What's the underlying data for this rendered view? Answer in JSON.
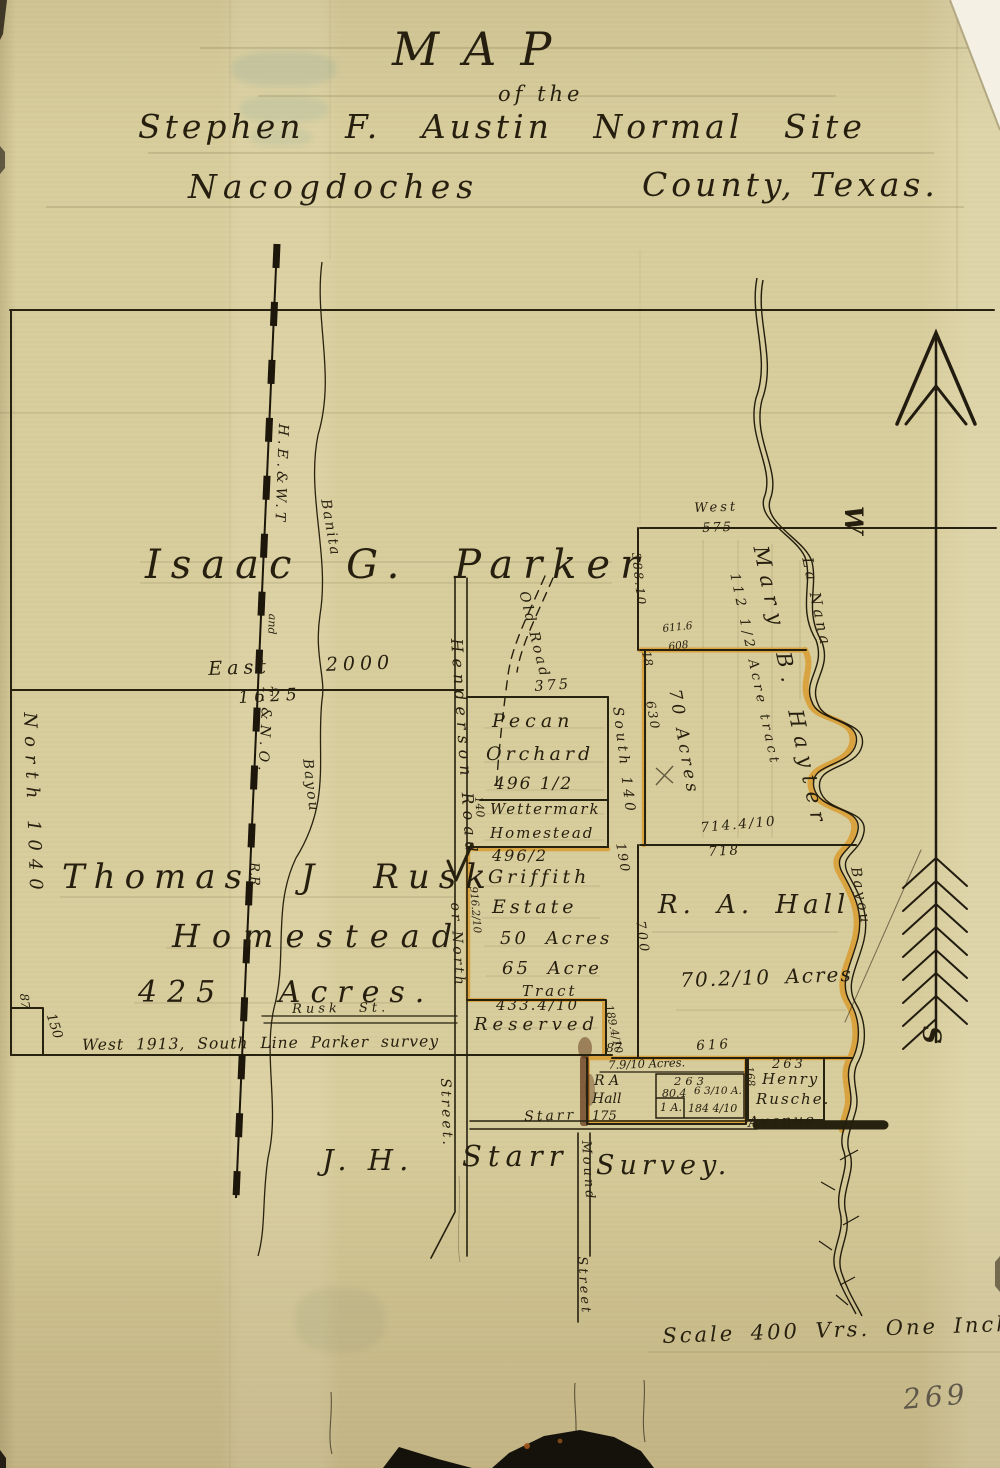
{
  "colors": {
    "paper": "#d8cd9c",
    "ink": "#261f0f",
    "highlight": "#d99b2c",
    "pencil": "#5e574a"
  },
  "title": {
    "map": "MAP",
    "of_the": "of the",
    "line3": "Stephen F. Austin Normal Site",
    "line4a": "Nacogdoches",
    "line4b": "County, Texas."
  },
  "parker": {
    "owner": "Isaac G. Parker",
    "east_dim": "East 2000",
    "east_dim2": "1625",
    "west_dim": "North 1040",
    "south_line": "West 1913, South Line Parker survey",
    "notch_h": "87",
    "notch_w": "150"
  },
  "rusk": {
    "name": "Thomas J Rusk",
    "name2": "Homestead",
    "acres": "425 Acres."
  },
  "railroad": {
    "part1": "H.E.&W.T",
    "part2": "and",
    "part3": "T.&N.O.",
    "part4": "R.R."
  },
  "streams": {
    "banita": "Banita",
    "banita_bayou": "Bayou",
    "lanana": "La Nana",
    "lanana_bayou": "Bayou"
  },
  "roads": {
    "henderson": "Henderson Road",
    "henderson2": "or North",
    "henderson3": "Street.",
    "henderson_dim": "916.2/10",
    "old_road": "Old Road",
    "old_road_dim": "375",
    "rusk_st": "Rusk St.",
    "starr": "Starr",
    "avenue": "Avenue",
    "mound": "Mound",
    "mound2": "Street"
  },
  "tracts": {
    "pecan": {
      "name": "Pecan",
      "name2": "Orchard",
      "dim": "496 1/2",
      "east": "South 140",
      "east2": "190",
      "west": "140"
    },
    "wettermark": {
      "name": "Wettermark",
      "name2": "Homestead",
      "dim": "496/2"
    },
    "griffith": {
      "name": "Griffith",
      "name2": "Estate",
      "acres": "50 Acres",
      "tract": "65 Acre",
      "tract2": "Tract"
    },
    "reserved": {
      "dim": "433.4/10",
      "name": "Reserved",
      "east_dim": "189.4/10",
      "corner": "87"
    },
    "hayter": {
      "top": "West",
      "top_dim": "575",
      "name": "Mary B. Hayter",
      "tract": "112 1/2 Acre tract",
      "acres": "70 Acres",
      "w1": "388.10",
      "w2": "18",
      "mid1": "611.6",
      "mid2": "608",
      "w3": "630",
      "s1": "714.4/10",
      "s2": "718"
    },
    "hall": {
      "name": "R. A. Hall",
      "acres": "70.2/10 Acres",
      "west": "700",
      "south": "616"
    },
    "hall_small": {
      "acres": "7.9/10 Acres.",
      "owner1": "R A",
      "owner2": "Hall",
      "d175": "175",
      "d263": "263",
      "d804": "80.4",
      "d63": "6 3/10 A.",
      "d1a": "1 A.",
      "d184": "184 4/10",
      "east": "168"
    },
    "rusche": {
      "dim": "263",
      "owner1": "Henry",
      "owner2": "Rusche."
    }
  },
  "starr_survey": {
    "part1": "J. H.",
    "part2": "Starr",
    "part3": "Survey."
  },
  "compass": {
    "west": "W",
    "south": "S"
  },
  "footer": {
    "scale": "Scale 400 Vrs. One Inch",
    "page_number": "269"
  }
}
